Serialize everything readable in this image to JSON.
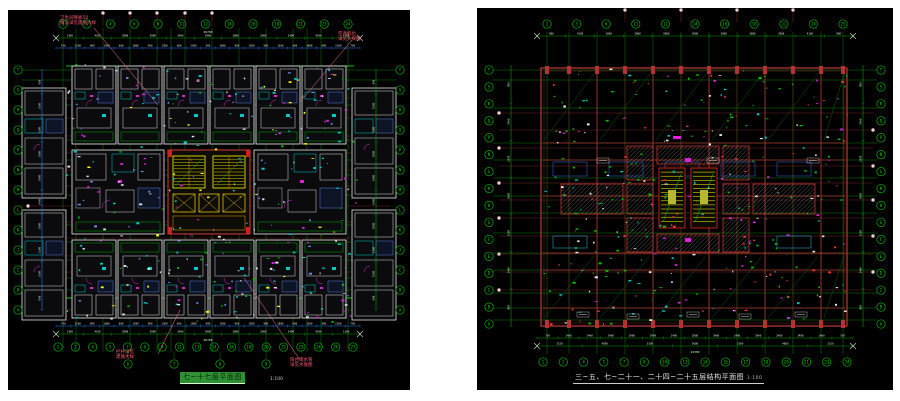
{
  "page": {
    "background": "#ffffff",
    "description": "两张CAD楼层平面图"
  },
  "colors": {
    "canvas": "#000000",
    "grid_green": "#00b400",
    "axis_maroon": "#7a3333",
    "dim_cyan_line": "#2277ee",
    "note_red": "#ff5b77",
    "beam_red": "#b03434",
    "stair_yellow": "#ffff00",
    "fixture_magenta": "#dd22dd",
    "wall_white": "#d4d4d4"
  },
  "left_panel": {
    "title": "七~十七层平面图",
    "scale": "1:100",
    "axis_top": [
      "1",
      "3",
      "4",
      "6",
      "8",
      "11",
      "12",
      "14",
      "16",
      "18",
      "21",
      "23",
      "24"
    ],
    "axis_bottom": [
      "1",
      "2",
      "4",
      "5",
      "7",
      "8",
      "9",
      "11",
      "13",
      "14",
      "16",
      "18",
      "20",
      "21",
      "23",
      "24",
      "26",
      "27"
    ],
    "axis_bottom2": [
      "6",
      "7",
      "8",
      "9"
    ],
    "axis_left": [
      "T",
      "S",
      "R",
      "Q",
      "P",
      "N",
      "M",
      "L",
      "K",
      "J",
      "C",
      "B",
      "A"
    ],
    "axis_right": [
      "T",
      "S",
      "R",
      "Q",
      "P",
      "N",
      "M",
      "L",
      "K",
      "J",
      "C",
      "B",
      "A"
    ],
    "dims_top_outer": [
      "1300",
      "4100",
      "2800",
      "2900",
      "2400",
      "2900",
      "2800",
      "2900",
      "2400",
      "4100",
      "1300"
    ],
    "dims_top_inner": [
      "750",
      "2100",
      "900",
      "1500",
      "600",
      "1800",
      "900",
      "1200",
      "600",
      "1500",
      "900",
      "1800",
      "600",
      "1200",
      "900",
      "1500",
      "600",
      "1800",
      "900",
      "2100",
      "750"
    ],
    "dims_bottom_inner": [
      "750",
      "2100",
      "900",
      "1800",
      "600",
      "1500",
      "900",
      "1200",
      "600",
      "1800",
      "900",
      "1500",
      "600",
      "1200",
      "900",
      "1800",
      "600",
      "1500",
      "900",
      "2100",
      "750"
    ],
    "dims_bottom_outer": [
      "1300",
      "4100",
      "2800",
      "2900",
      "2400",
      "2900",
      "2800",
      "2900",
      "2400",
      "4100",
      "1300"
    ],
    "dims_left": [
      "600",
      "1500",
      "2100",
      "1800",
      "2400",
      "2400",
      "1800",
      "2100",
      "1500",
      "600"
    ],
    "total_width_label": "26700",
    "notes": {
      "top_left": "卫生间降板50\n做法详见建施大样",
      "top_right": "空调机位\n详见大样图",
      "bottom_left": "栏杆详见\n建施大样",
      "bottom_right": "阳台雨水管\n详见水施图"
    }
  },
  "right_panel": {
    "title": "三~五、七~二十一、二十四~二十五层结构平面图",
    "scale": "1:100",
    "axis_top": [
      "1",
      "3",
      "6",
      "11",
      "12",
      "14",
      "16",
      "18",
      "21",
      "24",
      "25"
    ],
    "axis_bottom": [
      "1",
      "2",
      "4",
      "5",
      "7",
      "8",
      "10",
      "13",
      "14",
      "16",
      "17",
      "18",
      "20",
      "21",
      "23",
      "24"
    ],
    "axis_left": [
      "T",
      "S",
      "R",
      "Q",
      "P",
      "N",
      "L",
      "K",
      "H",
      "G",
      "F",
      "E",
      "D",
      "C",
      "B",
      "A"
    ],
    "axis_right": [
      "T",
      "S",
      "R",
      "Q",
      "P",
      "N",
      "L",
      "K",
      "H",
      "G",
      "F",
      "E",
      "D",
      "C",
      "B",
      "A"
    ],
    "dims_top": [
      "900",
      "4100",
      "2800",
      "2800",
      "2800",
      "3000",
      "2800",
      "2800",
      "2800",
      "4100",
      "900"
    ],
    "dims_bottom_inner": [
      "750",
      "1400",
      "2400",
      "2400",
      "2900",
      "2400",
      "2400",
      "2900",
      "2400",
      "2400",
      "2900",
      "2400",
      "2400",
      "1400",
      "750"
    ],
    "dims_bottom_outer": [
      "2150",
      "4800",
      "5300",
      "5600",
      "5300",
      "4800",
      "2150"
    ],
    "dims_left": [
      "900",
      "2400",
      "3300",
      "3000",
      "3300",
      "2400",
      "900"
    ],
    "total_width_label": "24300"
  }
}
